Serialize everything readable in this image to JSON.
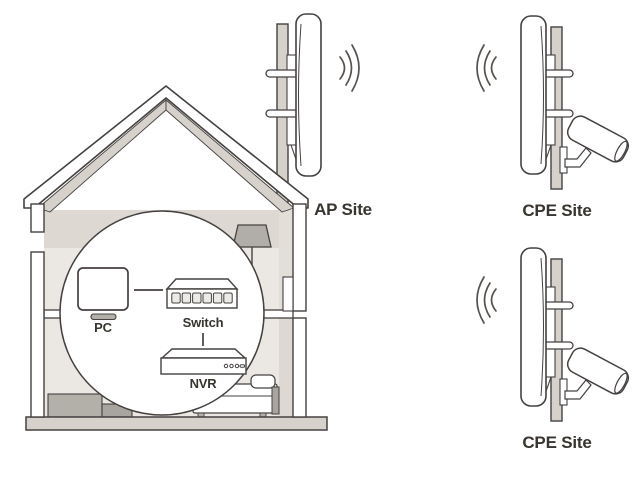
{
  "diagram": {
    "type": "wireless-surveillance-network-topology",
    "sites": [
      {
        "id": "ap-site",
        "label": "AP Site",
        "equipment_icon": "panel-antenna-on-pole"
      },
      {
        "id": "cpe-site-top",
        "label": "CPE Site",
        "equipment_icon": "panel-antenna-with-camera-on-pole"
      },
      {
        "id": "cpe-site-bottom",
        "label": "CPE Site",
        "equipment_icon": "panel-antenna-with-camera-on-pole"
      }
    ],
    "indoor_devices": [
      {
        "id": "pc",
        "label": "PC",
        "icon": "monitor-icon"
      },
      {
        "id": "switch",
        "label": "Switch",
        "icon": "ethernet-switch-icon"
      },
      {
        "id": "nvr",
        "label": "NVR",
        "icon": "nvr-box-icon"
      }
    ],
    "connections": [
      {
        "from": "PC",
        "to": "Switch"
      },
      {
        "from": "Switch",
        "to": "NVR"
      }
    ],
    "colors": {
      "outline": "#454140",
      "metal_gray": "#d6d2cb",
      "interior_gray": "#ebe8e4",
      "shade_gray": "#ddd8d2",
      "furniture_gray": "#b1ada8",
      "text": "#38342f",
      "background": "#ffffff"
    }
  }
}
